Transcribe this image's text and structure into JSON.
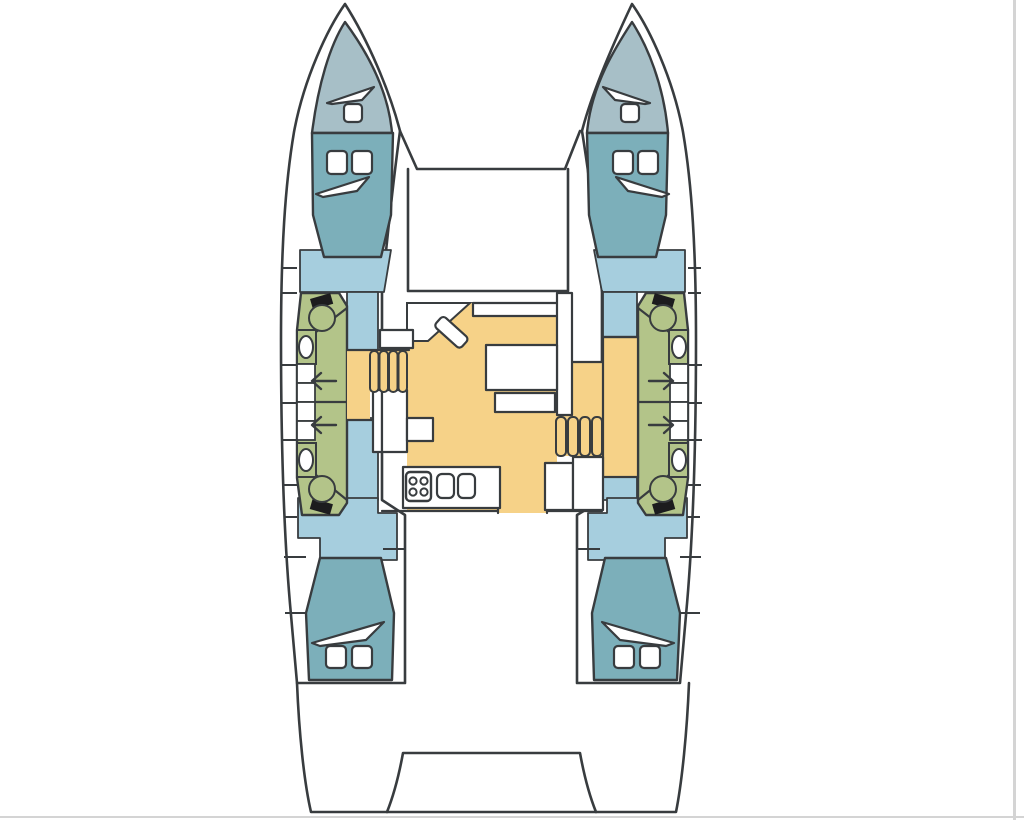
{
  "palette": {
    "ink": "#383c3f",
    "hull_white": "#ffffff",
    "bow_locker": "#a7bfc7",
    "cabin_teal": "#7cafba",
    "walkway_blue": "#a6cede",
    "head_green": "#b3c489",
    "saloon_yellow": "#f6d288",
    "fixture_black": "#1c1c1e",
    "edge_gray": "#d4d4d4",
    "fixture_white": "#ffffff"
  },
  "diagram": {
    "type": "catamaran-deck-plan",
    "orientation": "bow-up",
    "hulls": [
      "port",
      "starboard"
    ],
    "spaces": [
      {
        "name": "port-forepeak-locker",
        "color": "bow_locker"
      },
      {
        "name": "starboard-forepeak-locker",
        "color": "bow_locker"
      },
      {
        "name": "port-forward-cabin-berth",
        "color": "cabin_teal"
      },
      {
        "name": "starboard-forward-cabin-berth",
        "color": "cabin_teal"
      },
      {
        "name": "port-aft-cabin-berth",
        "color": "cabin_teal"
      },
      {
        "name": "starboard-aft-cabin-berth",
        "color": "cabin_teal"
      },
      {
        "name": "port-head-bathroom",
        "color": "head_green"
      },
      {
        "name": "starboard-head-bathroom",
        "color": "head_green"
      },
      {
        "name": "port-hull-walkway",
        "color": "walkway_blue"
      },
      {
        "name": "starboard-hull-walkway",
        "color": "walkway_blue"
      },
      {
        "name": "saloon-and-galley-sole",
        "color": "saloon_yellow"
      }
    ],
    "fixtures": {
      "deck_hatches": 10,
      "hull_windows": 6,
      "toilets": 4,
      "washbasins": 4,
      "companionway_steps_port": 4,
      "companionway_steps_starboard": 4,
      "stove_burners": 4,
      "sink_basins": 2,
      "door_direction_arrows": 4,
      "dining_table": 1,
      "side_table": 1,
      "nav_seat": 1,
      "aft_platform": 1
    }
  }
}
